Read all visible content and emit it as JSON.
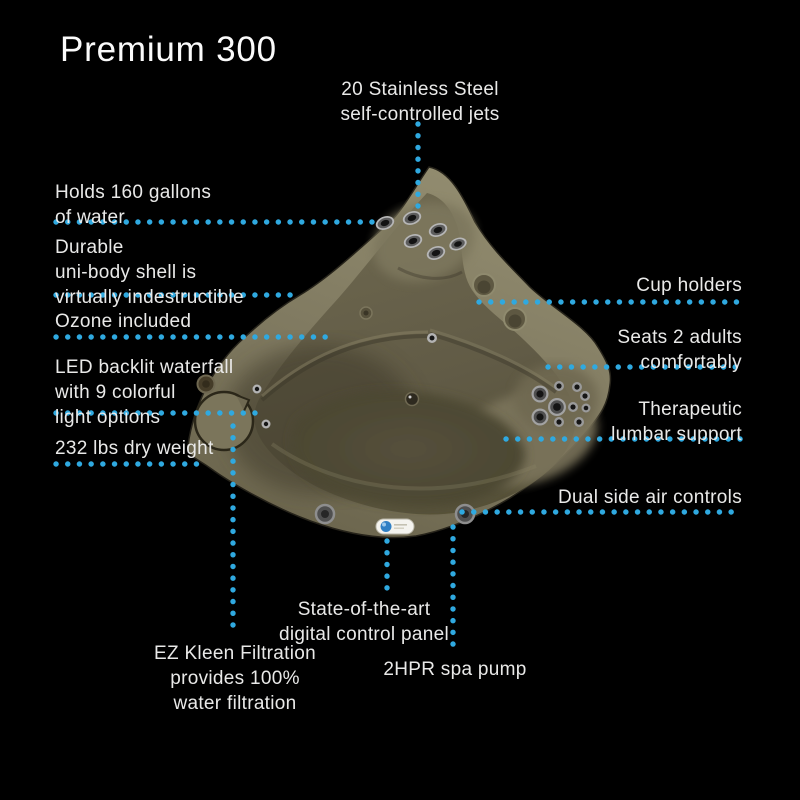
{
  "title": "Premium 300",
  "theme": {
    "background": "#000000",
    "text_color": "#e9e9e8",
    "accent_dotted_line": "#2fa9e0",
    "tub_shell_color": "#837c62"
  },
  "callouts": {
    "jets": "20 Stainless Steel\nself-controlled jets",
    "capacity": "Holds 160 gallons\nof water",
    "shell": "Durable\nuni-body shell is\nvirtually indestructible",
    "ozone": "Ozone included",
    "waterfall": "LED backlit waterfall\nwith 9 colorful\nlight options",
    "dry_weight": "232 lbs dry weight",
    "cup_holders": "Cup holders",
    "seating": "Seats 2 adults\ncomfortably",
    "lumbar": "Therapeutic\nlumbar support",
    "air_controls": "Dual side air controls",
    "control_panel": "State-of-the-art\ndigital control panel",
    "filtration": "EZ Kleen Filtration\nprovides 100%\nwater filtration",
    "pump": "2HPR spa pump"
  }
}
